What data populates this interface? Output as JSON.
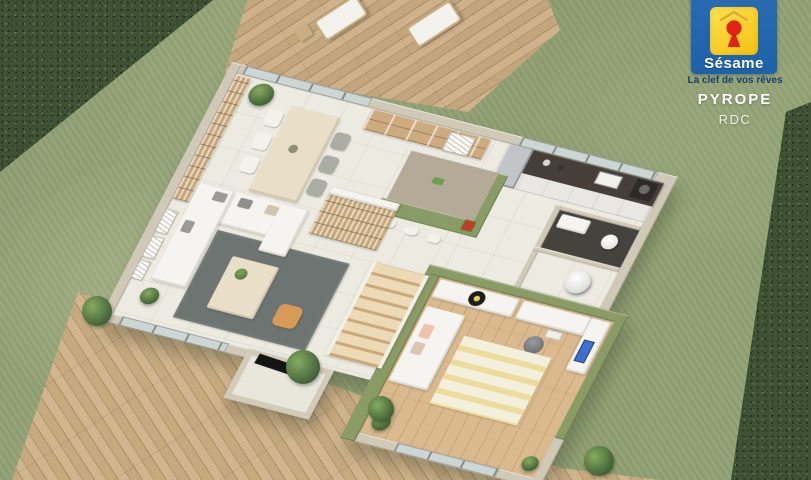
{
  "brand": {
    "top_text": "MAISONS",
    "name": "Sésame",
    "tagline": "La clef de vos rêves",
    "colors": {
      "logo_blue": "#2166ad",
      "logo_yellow": "#ffd92b",
      "keyhole_red": "#e02417",
      "tagline_navy": "#1b3d71",
      "text_white": "#ffffff"
    }
  },
  "plan": {
    "name": "PYROPE",
    "level": "RDC"
  },
  "scene": {
    "type": "3d-floor-plan-render",
    "palette": {
      "grass": "#93a173",
      "hedge": "#3f5236",
      "deck_wood": "#c9ab85",
      "exterior_wall": "#d0c9b8",
      "accent_wall_green": "#8a9b66",
      "tile_floor": "#edeae1",
      "wood_floor": "#d9b98d",
      "living_rug": "#6d7472",
      "kitchen_counter": "#463e38",
      "pouf_orange": "#d89a58"
    }
  }
}
